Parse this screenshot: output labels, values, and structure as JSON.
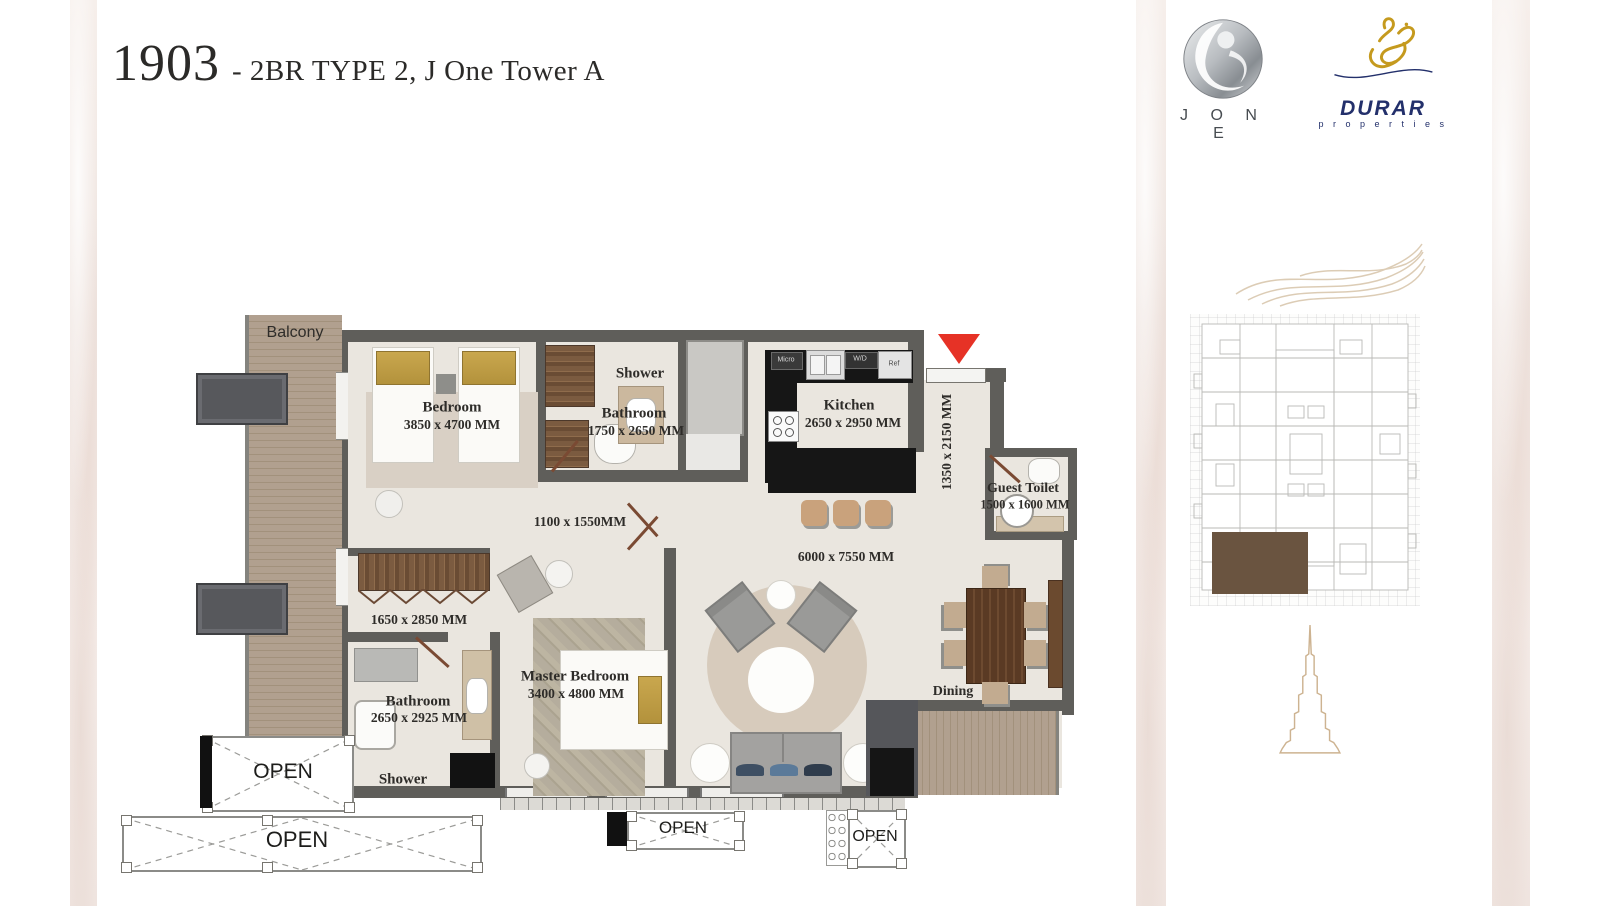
{
  "header": {
    "unit_number": "1903",
    "subtitle": "- 2BR TYPE 2, J One Tower A"
  },
  "branding": {
    "jone_wordmark": "J O N E",
    "durar_wordmark": "DURAR",
    "durar_tagline": "p r o p e r t i e s"
  },
  "floorplan": {
    "balcony_label": "Balcony",
    "bedroom": {
      "name": "Bedroom",
      "dims": "3850 x 4700 MM"
    },
    "upper_bathroom": {
      "shower": "Shower",
      "name": "Bathroom",
      "dims": "1750 x 2650 MM"
    },
    "kitchen": {
      "name": "Kitchen",
      "dims": "2650 x 2950 MM",
      "appliances": {
        "micro": "Micro",
        "washer": "W/D",
        "fridge": "Ref"
      }
    },
    "entry_hall_dims": "1350 x 2150 MM",
    "guest_toilet": {
      "name": "Guest Toilet",
      "dims": "1500 x 1600 MM"
    },
    "corridor_dims": "1100 x 1550MM",
    "wardrobe_dims": "1650 x 2850 MM",
    "living_dims": "6000 x 7550 MM",
    "master_bedroom": {
      "name": "Master Bedroom",
      "dims": "3400 x 4800 MM"
    },
    "master_bathroom": {
      "name": "Bathroom",
      "dims": "2650 x 2925 MM",
      "shower": "Shower"
    },
    "dining_label": "Dining",
    "open_labels": [
      "OPEN",
      "OPEN",
      "OPEN",
      "OPEN"
    ]
  },
  "colors": {
    "wall": "#5f5e5a",
    "floor": "#eae6df",
    "counter": "#161616",
    "arrow": "#e63226",
    "highlight": "#6a5440",
    "tan": "#d9c7ae",
    "gold": "#c9a74e",
    "wood": "#5a3a24",
    "navy": "#23306b",
    "gold_logo": "#c59a1e"
  }
}
